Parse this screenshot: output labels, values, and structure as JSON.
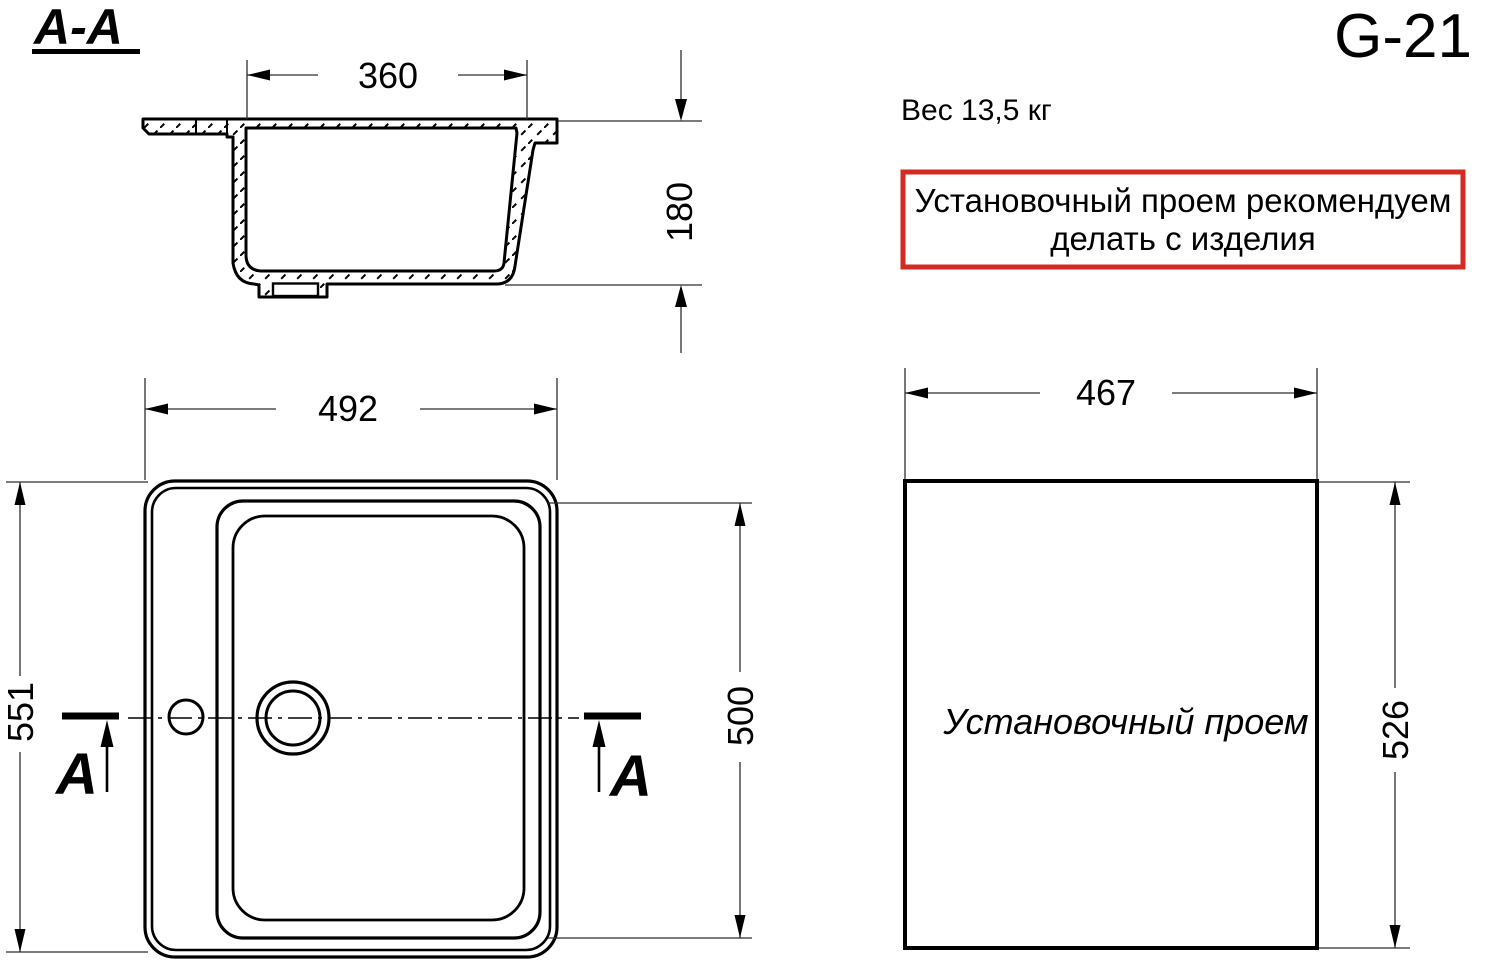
{
  "title": "G-21",
  "weight": "Вес 13,5 кг",
  "note": {
    "line1": "Установочный проем рекомендуем",
    "line2": "делать с изделия",
    "border_color": "#d42a24"
  },
  "section_view": {
    "label": "A-A",
    "dim_opening_width": "360",
    "dim_depth": "180"
  },
  "top_view": {
    "marker_left": "A",
    "marker_right": "A",
    "dim_width": "492",
    "dim_length": "551",
    "dim_bowl_length": "500"
  },
  "cutout": {
    "label": "Установочный проем",
    "dim_width": "467",
    "dim_length": "526"
  },
  "colors": {
    "line": "#000000",
    "note_border": "#d42a24"
  }
}
